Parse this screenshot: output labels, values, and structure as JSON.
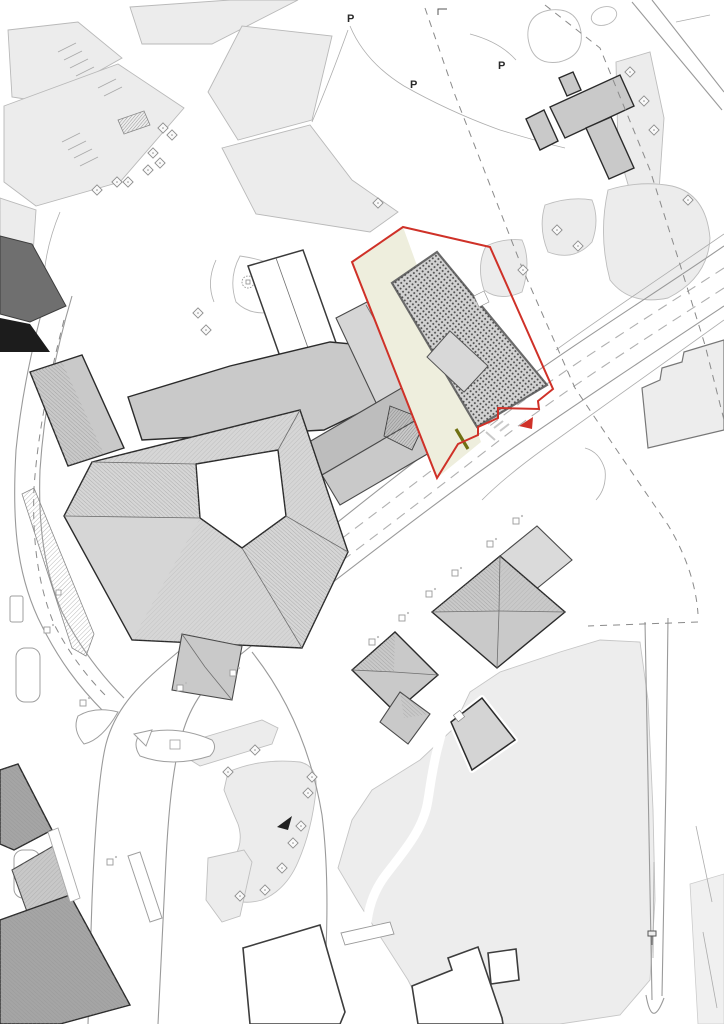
{
  "drawing": {
    "kind": "architectural-site-plan",
    "highlight": "red-outlined development parcel with dotted proposed building"
  },
  "colors": {
    "background": "#ffffff",
    "parkland": "#ececec",
    "parkland_stroke": "#b9b9b9",
    "plaza": "#ededed",
    "building_gray": "#c9c9c9",
    "building_light": "#d6d6d6",
    "building_mid": "#bdbdbd",
    "building_dark": "#6f6f6f",
    "building_black": "#1c1c1c",
    "outline": "#2b2b2b",
    "road_stroke": "#9a9a9a",
    "lane_dash": "#b0b0b0",
    "boundary_dash": "#8a8a8a",
    "site_boundary": "#cf3128",
    "site_ground": "#eeeedd",
    "proposed_fill": "#d2d2d2",
    "proposed_dots": "#4a4a4a",
    "accent_olive": "#6f7012",
    "arrow_black": "#222222"
  },
  "annotations": {
    "parking_flags": [
      {
        "x": 347,
        "y": 22,
        "label": "P"
      },
      {
        "x": 410,
        "y": 88,
        "label": "P"
      },
      {
        "x": 498,
        "y": 69,
        "label": "P"
      }
    ],
    "site_arrow": {
      "points": "519,426 533,417 532,429",
      "color": "#cf3128"
    },
    "garden_arrow": {
      "points": "277,827 292,816 288,830",
      "color": "#222222"
    }
  },
  "features": {
    "park_trees": [
      [
        163,
        128
      ],
      [
        172,
        135
      ],
      [
        153,
        153
      ],
      [
        160,
        163
      ],
      [
        148,
        170
      ],
      [
        117,
        182
      ],
      [
        128,
        182
      ],
      [
        97,
        190
      ]
    ],
    "green_trees": [
      [
        630,
        72
      ],
      [
        644,
        101
      ],
      [
        654,
        130
      ],
      [
        688,
        200
      ],
      [
        557,
        230
      ],
      [
        578,
        246
      ],
      [
        523,
        270
      ],
      [
        378,
        203
      ],
      [
        198,
        313
      ],
      [
        206,
        330
      ]
    ],
    "garden_trees": [
      [
        255,
        750
      ],
      [
        228,
        772
      ],
      [
        312,
        777
      ],
      [
        308,
        793
      ],
      [
        301,
        826
      ],
      [
        293,
        843
      ],
      [
        282,
        868
      ],
      [
        265,
        890
      ],
      [
        240,
        896
      ]
    ],
    "road_markers": [
      [
        372,
        642
      ],
      [
        402,
        618
      ],
      [
        429,
        594
      ],
      [
        455,
        573
      ],
      [
        490,
        544
      ],
      [
        516,
        521
      ]
    ],
    "junction_markers": [
      [
        83,
        703
      ],
      [
        180,
        688
      ],
      [
        233,
        673
      ],
      [
        47,
        630
      ],
      [
        110,
        862
      ]
    ],
    "sign_post": {
      "x": 652,
      "y": 938
    }
  }
}
